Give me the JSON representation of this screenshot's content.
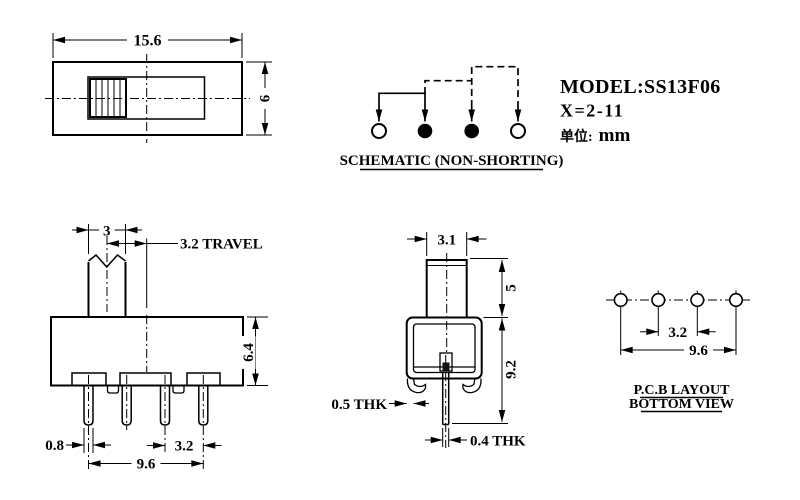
{
  "title_block": {
    "model": "MODEL:SS13F06",
    "x_range": "X=2-11",
    "unit_label": "单位:",
    "unit_value": "mm"
  },
  "top_view": {
    "width": "15.6",
    "height": "6"
  },
  "schematic": {
    "caption": "SCHEMATIC (NON-SHORTING)",
    "terminals": [
      "open",
      "filled",
      "filled",
      "open"
    ]
  },
  "front_view": {
    "knob_width": "3",
    "travel": "3.2 TRAVEL",
    "body_height": "6.4",
    "pin_width": "0.8",
    "pin_pitch": "3.2",
    "pin_span": "9.6"
  },
  "side_view": {
    "knob_width": "3.1",
    "knob_height": "5",
    "total_height": "9.2",
    "shell_thickness": "0.5 THK",
    "pin_thickness": "0.4 THK"
  },
  "pcb_layout": {
    "pitch": "3.2",
    "span": "9.6",
    "caption_line1": "P.C.B LAYOUT",
    "caption_line2": "BOTTOM VIEW"
  }
}
